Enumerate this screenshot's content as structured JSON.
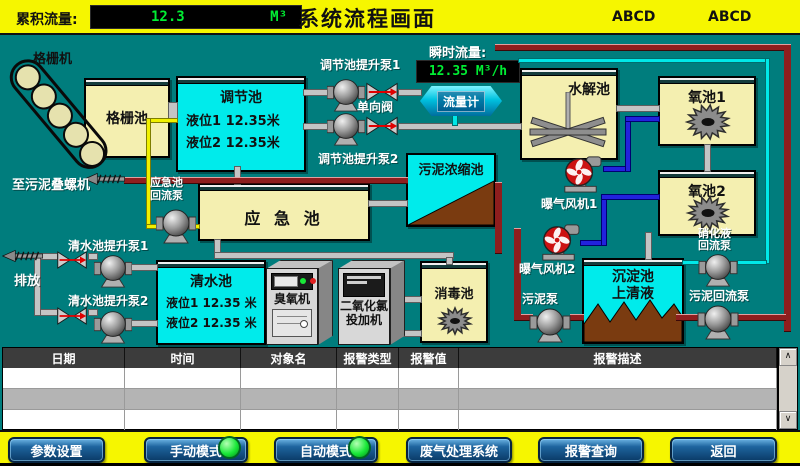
{
  "colors": {
    "bg_teal": "#007d7d",
    "bar_yellow": "#f6f600",
    "pool_yellow": "#f4efb0",
    "pool_cyan": "#00ebeb",
    "led_green": "#00ee33",
    "pipe_red": "#8e1e1e",
    "pipe_blue": "#2222dd",
    "pipe_cyan": "#00e8e8",
    "pipe_yellow": "#f0f000",
    "button_blue": "#1e649e",
    "sludge_brown": "#7a3b10"
  },
  "topbar": {
    "cum_label": "累积流量:",
    "cum_value": "12.3",
    "cum_unit": "M³",
    "title": "系统流程画面",
    "tag1": "ABCD",
    "tag2": "ABCD"
  },
  "flow": {
    "grid_machine": "格栅机",
    "grid_pool": "格栅池",
    "to_screw": "至污泥叠螺机",
    "tiaojie_title": "调节池",
    "tiaojie_level1": "液位1  12.35米",
    "tiaojie_level2": "液位2  12.35米",
    "tj_pump1": "调节池提升泵1",
    "tj_pump2": "调节池提升泵2",
    "check_valve": "单向阀",
    "instant_label": "瞬时流量:",
    "instant_value": "12.35 M³/h",
    "flowmeter": "流量计",
    "shuijie": "水解池",
    "yangchi1": "氧池1",
    "yangchi2": "氧池2",
    "wuni_nongsuo": "污泥浓缩池",
    "yingji": "应 急 池",
    "yingji_pump_l1": "应急池",
    "yingji_pump_l2": "回流泵",
    "blower1": "曝气风机1",
    "blower2": "曝气风机2",
    "paifang": "排放",
    "qs_pump1": "清水池提升泵1",
    "qs_pump2": "清水池提升泵2",
    "qingshui_title": "清水池",
    "qingshui_level1": "液位1 12.35 米",
    "qingshui_level2": "液位2 12.35 米",
    "ozone": "臭氧机",
    "dioxide_l1": "二氧化氯",
    "dioxide_l2": "投加机",
    "xiaodu": "消毒池",
    "chendian_l1": "沉淀池",
    "chendian_l2": "上清液",
    "nitri_pump_l1": "硝化液",
    "nitri_pump_l2": "回流泵",
    "sludge_return_pump": "污泥回流泵",
    "sludge_pump": "污泥泵"
  },
  "table": {
    "headers": [
      "日期",
      "时间",
      "对象名",
      "报警类型",
      "报警值",
      "报警描述"
    ]
  },
  "scroll": {
    "up": "∧",
    "down": "∨"
  },
  "buttons": [
    {
      "label": "参数设置"
    },
    {
      "label": "手动模式",
      "led": true
    },
    {
      "label": "自动模式",
      "led": true
    },
    {
      "label": "废气处理系统"
    },
    {
      "label": "报警查询"
    },
    {
      "label": "返回"
    }
  ]
}
